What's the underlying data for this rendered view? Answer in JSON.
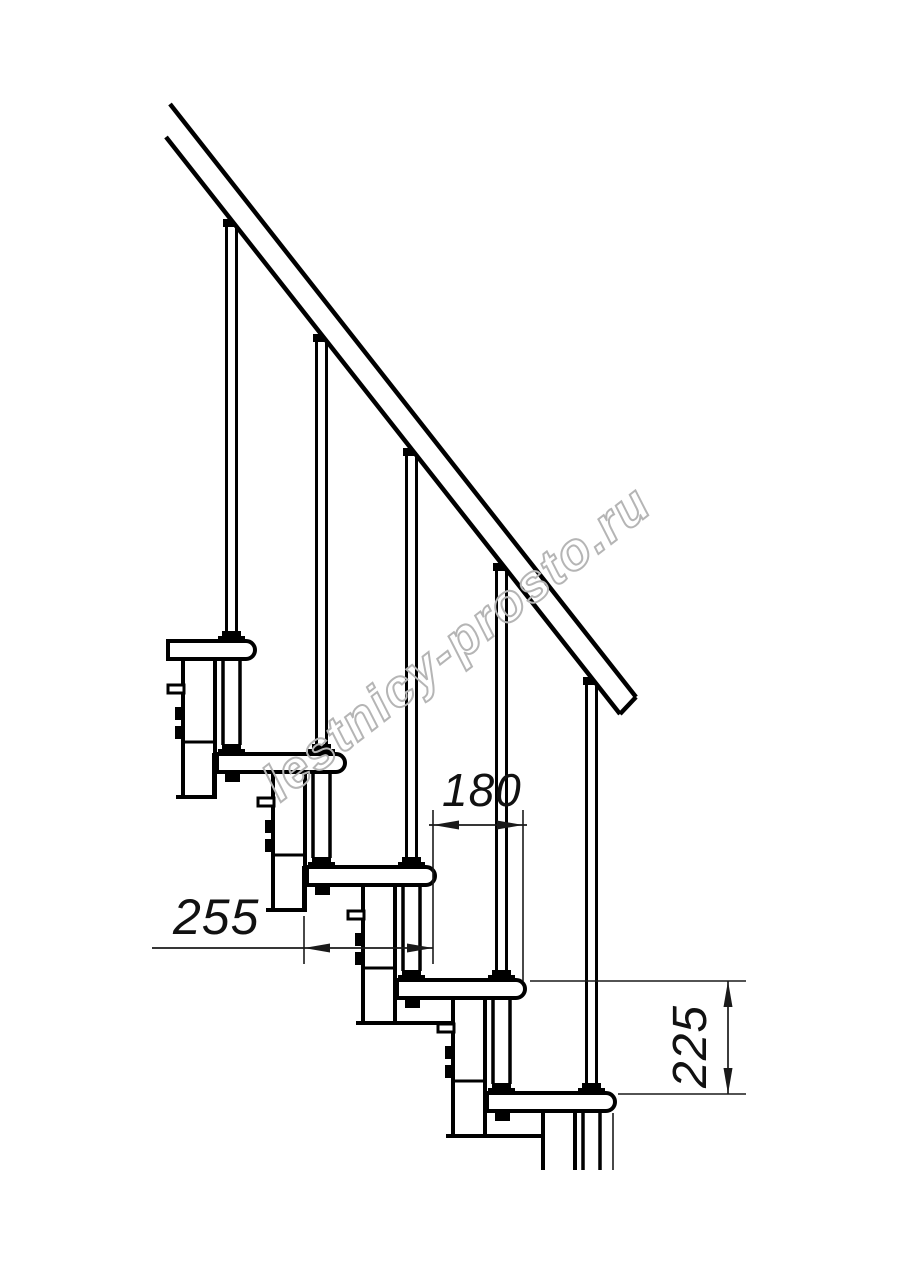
{
  "drawing": {
    "title_visible": "",
    "dimensions": {
      "tread_depth": "255",
      "step_run": "180",
      "step_rise": "225"
    },
    "watermark": "lestnicy-prosto.ru",
    "colors": {
      "line": "#000000",
      "dimension_line": "#1a1a1a",
      "watermark_gray": "#b5b5b5",
      "background": "#ffffff"
    }
  }
}
